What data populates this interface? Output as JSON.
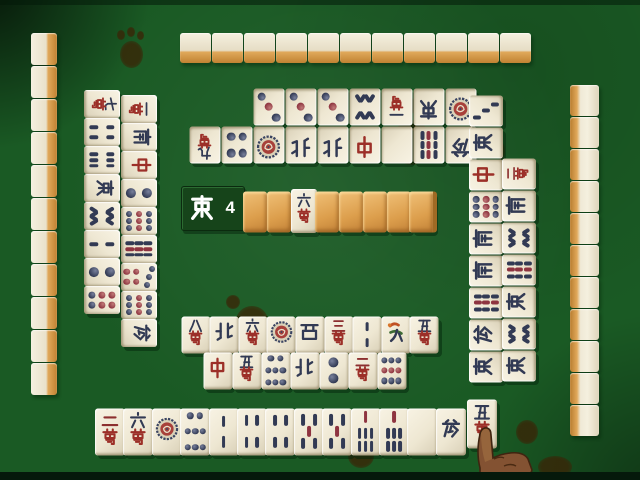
{
  "game": {
    "name": "mahjong-table",
    "round_indicator": {
      "wind": "East",
      "wind_kanji": "東",
      "number": "4"
    }
  },
  "dead_wall": {
    "tiles": [
      "back",
      "back",
      "6m",
      "back",
      "back",
      "back",
      "back",
      "back"
    ],
    "face_up_index": 2,
    "face_up_tile": "6m"
  },
  "walls": {
    "top": {
      "count": 11
    },
    "left": {
      "count": 11
    },
    "right": {
      "count": 11
    }
  },
  "discards": {
    "top": {
      "row1": [
        "3p",
        "3p",
        "3p",
        "8s",
        "1m",
        "E",
        "1p"
      ],
      "row2": [
        "9m",
        "4p",
        "1p",
        "N",
        "N",
        "C",
        "B",
        "9s",
        "F"
      ]
    },
    "left": {
      "col1": [
        "7m",
        "4s",
        "6s",
        "E",
        "8s",
        "2s",
        "2p",
        "6p"
      ],
      "col2": [
        "1m",
        "S",
        "C",
        "2p",
        "9p",
        "9s",
        "7p",
        "9p",
        "F"
      ]
    },
    "right": {
      "col1": [
        "3s",
        "E",
        "C",
        "9p",
        "S",
        "S",
        "9s",
        "F",
        "E"
      ],
      "col2": [
        "2m",
        "S",
        "8s",
        "9s",
        "E",
        "8s",
        "E"
      ]
    },
    "bottom": {
      "row1": [
        "8m",
        "N",
        "6m",
        "1p",
        "W",
        "3m",
        "2s",
        "1s",
        "5m"
      ],
      "row2": [
        "C",
        "5m",
        "8p",
        "N",
        "2p",
        "2m",
        "9p"
      ]
    }
  },
  "hand": {
    "tiles": [
      "2m",
      "6m",
      "1p",
      "8p",
      "2s",
      "4s",
      "4s",
      "5s",
      "5s",
      "7s",
      "7s",
      "B",
      "F"
    ],
    "drawn_tile": "5m"
  },
  "cursor": {
    "name": "pointing-hand-cursor"
  },
  "tile_names": {
    "m": "man (characters)",
    "p": "pin (circles)",
    "s": "sou (bamboo)",
    "E": "east wind",
    "S": "south wind",
    "W": "west wind",
    "N": "north wind",
    "C": "red dragon (chun)",
    "F": "green dragon (hatsu)",
    "B": "white dragon (haku)",
    "back": "face-down tile"
  },
  "palette": {
    "felt": "#1a5a24",
    "tile_face": "#efe9d6",
    "tile_back_orange": "#d89a48",
    "ink_navy": "#323a54",
    "ink_red": "#9c2f28",
    "ink_maroon": "#8c2f2f",
    "indicator_bg": "#16441a",
    "indicator_text": "#ffffff",
    "skin": "#8d5c36"
  }
}
